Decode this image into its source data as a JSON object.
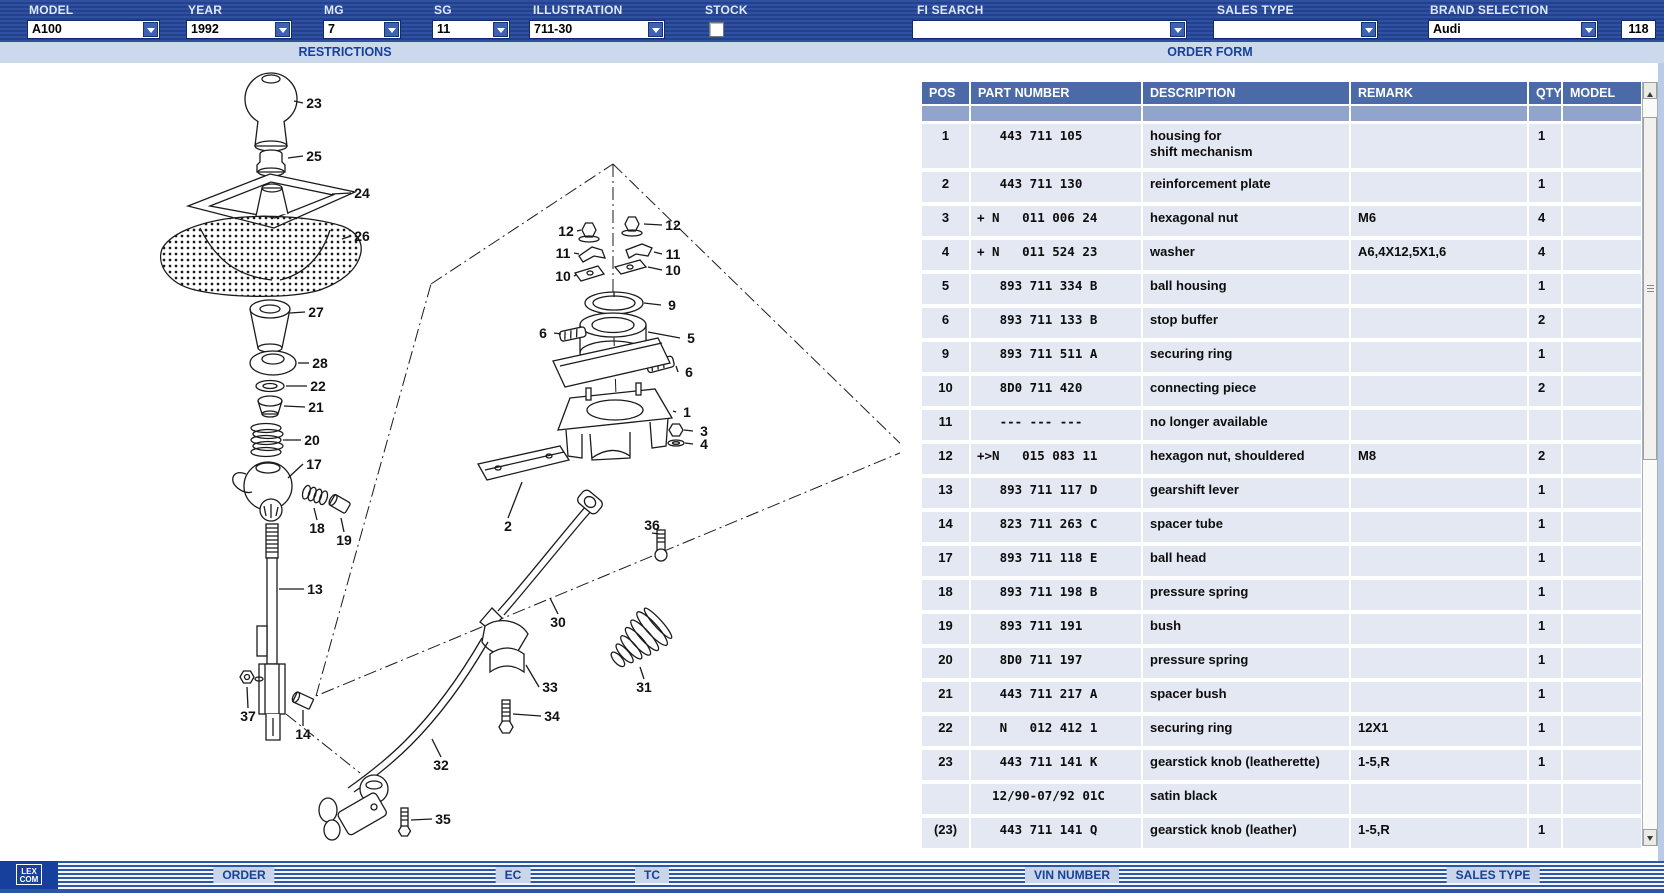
{
  "toolbar": {
    "fields": [
      {
        "label": "MODEL",
        "value": "A100"
      },
      {
        "label": "YEAR",
        "value": "1992"
      },
      {
        "label": "MG",
        "value": "7"
      },
      {
        "label": "SG",
        "value": "11"
      },
      {
        "label": "ILLUSTRATION",
        "value": "711-30"
      },
      {
        "label": "STOCK",
        "checked": false
      },
      {
        "label": "FI SEARCH",
        "value": ""
      },
      {
        "label": "SALES TYPE",
        "value": ""
      },
      {
        "label": "BRAND SELECTION",
        "value": "Audi"
      },
      {
        "label": "",
        "value": "118"
      }
    ]
  },
  "subbar": {
    "left": "RESTRICTIONS",
    "right": "ORDER FORM"
  },
  "table": {
    "columns": [
      "POS",
      "PART NUMBER",
      "DESCRIPTION",
      "REMARK",
      "QTY",
      "MODEL"
    ],
    "rows": [
      {
        "pos": "1",
        "part": "   443 711 105",
        "desc": "housing for\nshift mechanism",
        "remark": "",
        "qty": "1",
        "model": "",
        "tall": true
      },
      {
        "pos": "2",
        "part": "   443 711 130",
        "desc": "reinforcement plate",
        "remark": "",
        "qty": "1",
        "model": ""
      },
      {
        "pos": "3",
        "part": "+ N   011 006 24",
        "desc": "hexagonal nut",
        "remark": "M6",
        "qty": "4",
        "model": ""
      },
      {
        "pos": "4",
        "part": "+ N   011 524 23",
        "desc": "washer",
        "remark": "A6,4X12,5X1,6",
        "qty": "4",
        "model": ""
      },
      {
        "pos": "5",
        "part": "   893 711 334 B",
        "desc": "ball housing",
        "remark": "",
        "qty": "1",
        "model": ""
      },
      {
        "pos": "6",
        "part": "   893 711 133 B",
        "desc": "stop buffer",
        "remark": "",
        "qty": "2",
        "model": ""
      },
      {
        "pos": "9",
        "part": "   893 711 511 A",
        "desc": "securing ring",
        "remark": "",
        "qty": "1",
        "model": ""
      },
      {
        "pos": "10",
        "part": "   8D0 711 420",
        "desc": "connecting piece",
        "remark": "",
        "qty": "2",
        "model": ""
      },
      {
        "pos": "11",
        "part": "   --- --- ---",
        "desc": "no longer available",
        "remark": "",
        "qty": "",
        "model": ""
      },
      {
        "pos": "12",
        "part": "+>N   015 083 11",
        "desc": "hexagon nut, shouldered",
        "remark": "M8",
        "qty": "2",
        "model": ""
      },
      {
        "pos": "13",
        "part": "   893 711 117 D",
        "desc": "gearshift lever",
        "remark": "",
        "qty": "1",
        "model": ""
      },
      {
        "pos": "14",
        "part": "   823 711 263 C",
        "desc": "spacer tube",
        "remark": "",
        "qty": "1",
        "model": ""
      },
      {
        "pos": "17",
        "part": "   893 711 118 E",
        "desc": "ball head",
        "remark": "",
        "qty": "1",
        "model": ""
      },
      {
        "pos": "18",
        "part": "   893 711 198 B",
        "desc": "pressure spring",
        "remark": "",
        "qty": "1",
        "model": ""
      },
      {
        "pos": "19",
        "part": "   893 711 191",
        "desc": "bush",
        "remark": "",
        "qty": "1",
        "model": ""
      },
      {
        "pos": "20",
        "part": "   8D0 711 197",
        "desc": "pressure spring",
        "remark": "",
        "qty": "1",
        "model": ""
      },
      {
        "pos": "21",
        "part": "   443 711 217 A",
        "desc": "spacer bush",
        "remark": "",
        "qty": "1",
        "model": ""
      },
      {
        "pos": "22",
        "part": "   N   012 412 1",
        "desc": "securing ring",
        "remark": "12X1",
        "qty": "1",
        "model": ""
      },
      {
        "pos": "23",
        "part": "   443 711 141 K",
        "desc": "gearstick knob (leatherette)",
        "remark": "1-5,R",
        "qty": "1",
        "model": ""
      },
      {
        "pos": "",
        "part": "  12/90-07/92 01C",
        "desc": "satin black",
        "remark": "",
        "qty": "",
        "model": ""
      },
      {
        "pos": "(23)",
        "part": "   443 711 141 Q",
        "desc": "gearstick knob (leather)",
        "remark": "1-5,R",
        "qty": "1",
        "model": ""
      }
    ]
  },
  "diagram": {
    "callouts": [
      {
        "n": "23",
        "x": 284,
        "y": 37,
        "lx": 264,
        "ly": 35
      },
      {
        "n": "25",
        "x": 284,
        "y": 90,
        "lx": 258,
        "ly": 92
      },
      {
        "n": "24",
        "x": 332,
        "y": 127,
        "lx": 302,
        "ly": 128
      },
      {
        "n": "26",
        "x": 332,
        "y": 170,
        "lx": 312,
        "ly": 173
      },
      {
        "n": "27",
        "x": 286,
        "y": 246,
        "lx": 260,
        "ly": 247
      },
      {
        "n": "28",
        "x": 290,
        "y": 297,
        "lx": 268,
        "ly": 297
      },
      {
        "n": "22",
        "x": 288,
        "y": 320,
        "lx": 256,
        "ly": 320
      },
      {
        "n": "21",
        "x": 286,
        "y": 341,
        "lx": 254,
        "ly": 340
      },
      {
        "n": "20",
        "x": 282,
        "y": 374,
        "lx": 253,
        "ly": 374
      },
      {
        "n": "17",
        "x": 284,
        "y": 398,
        "lx": 258,
        "ly": 412
      },
      {
        "n": "18",
        "x": 287,
        "y": 462,
        "lx": 284,
        "ly": 442
      },
      {
        "n": "19",
        "x": 314,
        "y": 474,
        "lx": 311,
        "ly": 452
      },
      {
        "n": "13",
        "x": 285,
        "y": 523,
        "lx": 249,
        "ly": 523
      },
      {
        "n": "37",
        "x": 218,
        "y": 650,
        "lx": 217,
        "ly": 621
      },
      {
        "n": "14",
        "x": 273,
        "y": 668,
        "lx": 273,
        "ly": 644
      },
      {
        "n": "12",
        "x": 536,
        "y": 165,
        "lx": 551,
        "ly": 164
      },
      {
        "n": "12",
        "x": 643,
        "y": 159,
        "lx": 614,
        "ly": 158
      },
      {
        "n": "11",
        "x": 533,
        "y": 187,
        "lx": 549,
        "ly": 188
      },
      {
        "n": "11",
        "x": 643,
        "y": 188,
        "lx": 624,
        "ly": 186
      },
      {
        "n": "10",
        "x": 533,
        "y": 210,
        "lx": 546,
        "ly": 209
      },
      {
        "n": "10",
        "x": 643,
        "y": 204,
        "lx": 618,
        "ly": 201
      },
      {
        "n": "9",
        "x": 642,
        "y": 239,
        "lx": 614,
        "ly": 237
      },
      {
        "n": "5",
        "x": 661,
        "y": 272,
        "lx": 618,
        "ly": 266
      },
      {
        "n": "6",
        "x": 513,
        "y": 267,
        "lx": 531,
        "ly": 268
      },
      {
        "n": "6",
        "x": 659,
        "y": 306,
        "lx": 646,
        "ly": 300
      },
      {
        "n": "1",
        "x": 657,
        "y": 346,
        "lx": 643,
        "ly": 345
      },
      {
        "n": "3",
        "x": 674,
        "y": 365,
        "lx": 654,
        "ly": 364
      },
      {
        "n": "4",
        "x": 674,
        "y": 378,
        "lx": 655,
        "ly": 377
      },
      {
        "n": "2",
        "x": 478,
        "y": 460,
        "lx": 492,
        "ly": 416
      },
      {
        "n": "36",
        "x": 622,
        "y": 459,
        "lx": 629,
        "ly": 468
      },
      {
        "n": "30",
        "x": 528,
        "y": 556,
        "lx": 520,
        "ly": 532
      },
      {
        "n": "31",
        "x": 614,
        "y": 621,
        "lx": 610,
        "ly": 601
      },
      {
        "n": "33",
        "x": 520,
        "y": 621,
        "lx": 496,
        "ly": 599
      },
      {
        "n": "34",
        "x": 522,
        "y": 650,
        "lx": 483,
        "ly": 648
      },
      {
        "n": "32",
        "x": 411,
        "y": 699,
        "lx": 402,
        "ly": 673
      },
      {
        "n": "35",
        "x": 413,
        "y": 753,
        "lx": 381,
        "ly": 754
      }
    ]
  },
  "statusbar": {
    "logo_line1": "LEX",
    "logo_line2": "COM",
    "buttons": [
      "ORDER",
      "EC",
      "TC",
      "VIN NUMBER",
      "SALES TYPE"
    ]
  }
}
